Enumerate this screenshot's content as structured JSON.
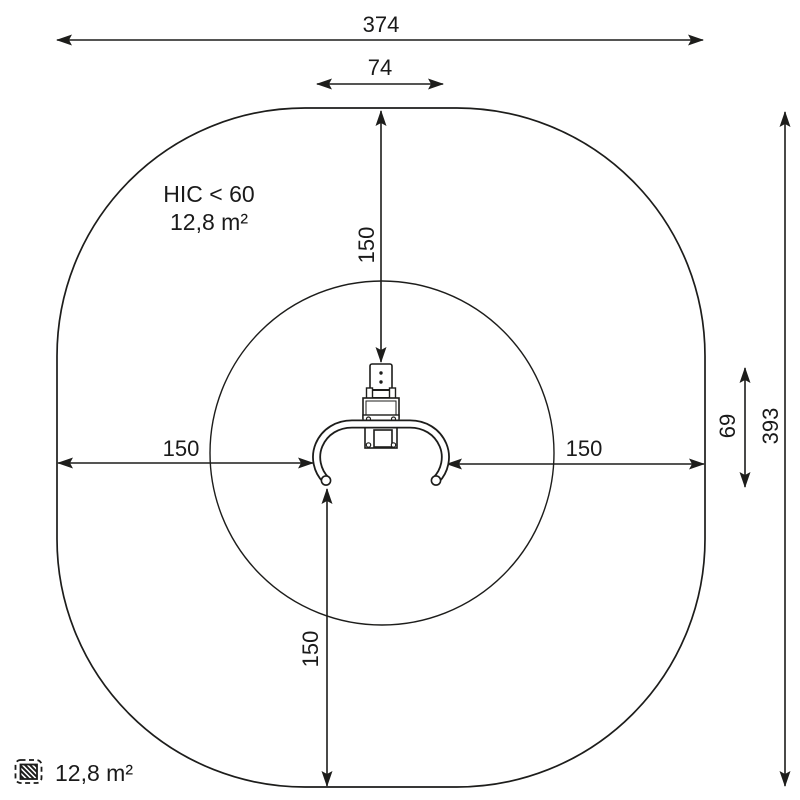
{
  "diagram": {
    "kind": "playground-equipment-safety-zone-top-view",
    "labels": {
      "total_width": "374",
      "equipment_width": "74",
      "total_height": "393",
      "equipment_extent": "69",
      "clearance_top": "150",
      "clearance_bottom": "150",
      "clearance_left": "150",
      "clearance_right": "150",
      "hic": "HIC < 60",
      "impact_area": "12,8 m²"
    },
    "legend": {
      "impact_area": "12,8 m²"
    },
    "colors": {
      "line": "#1d1d1b",
      "background": "#ffffff"
    }
  }
}
